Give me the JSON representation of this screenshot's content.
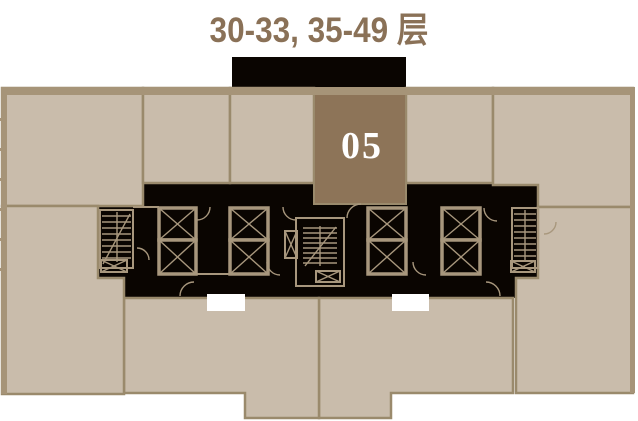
{
  "title": "30-33, 35-49 层",
  "plan": {
    "highlighted_unit": {
      "label": "05"
    }
  },
  "colors": {
    "title_text": "#8a7157",
    "unit_fill": "#c9bcab",
    "unit_border": "#9a8a6c",
    "outer_band": "#a69478",
    "highlight_unit_fill": "#8d7458",
    "highlight_unit_text": "#ffffff",
    "core_fill": "#0a0501",
    "core_line": "#a8977d",
    "opening_fill": "#ffffff",
    "background": "#ffffff"
  }
}
